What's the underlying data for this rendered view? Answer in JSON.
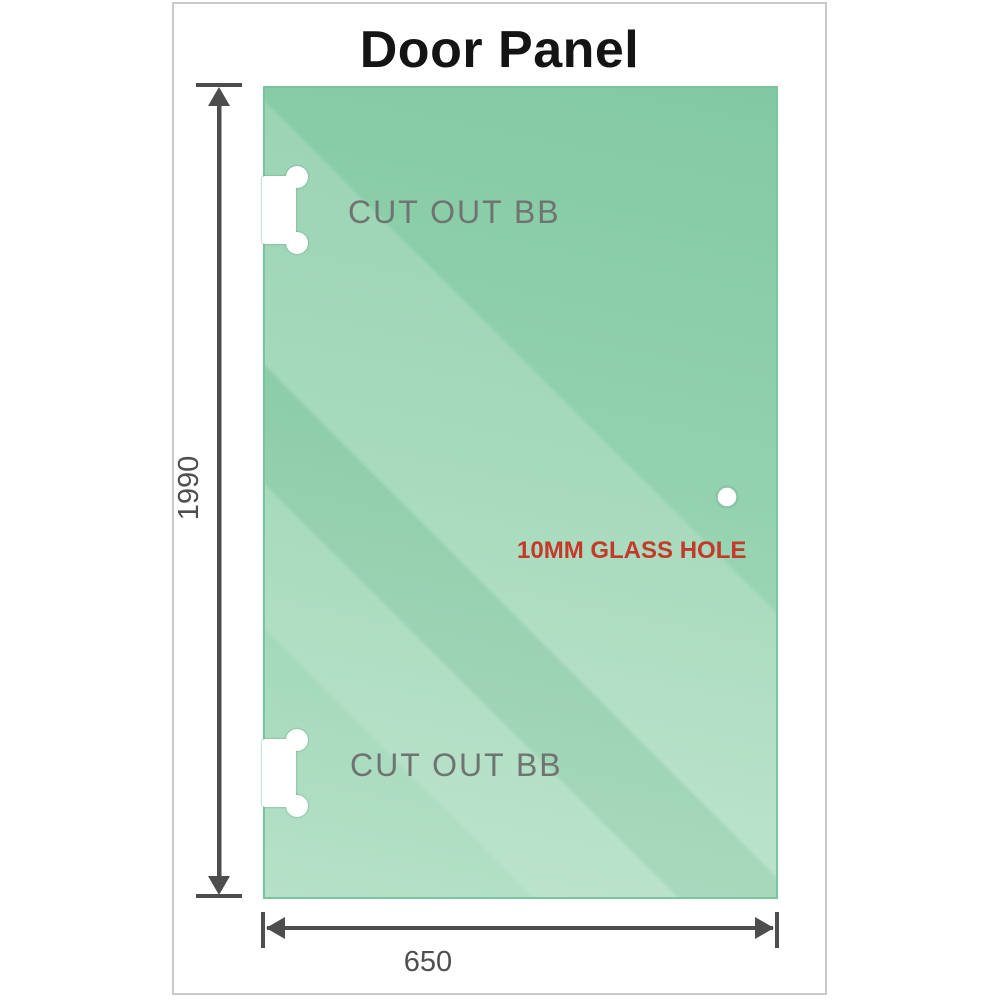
{
  "title": "Door Panel",
  "panel": {
    "cutout_top_label": "CUT OUT BB",
    "cutout_bottom_label": "CUT OUT BB",
    "glass_hole_label": "10MM GLASS HOLE"
  },
  "dimensions": {
    "height": "1990",
    "width": "650"
  },
  "colors": {
    "glass_green_dark": "#82c9a1",
    "glass_green_light": "#b6e1c8",
    "panel_edge_green": "#79c59d",
    "dimension_gray": "#4d4d4d",
    "dimension_text_gray": "#4f4f4f",
    "cutout_label_gray": "#6f7473",
    "annotation_red": "#c5392b",
    "frame_border_gray": "#c9c9c9",
    "title_black": "#141414"
  }
}
